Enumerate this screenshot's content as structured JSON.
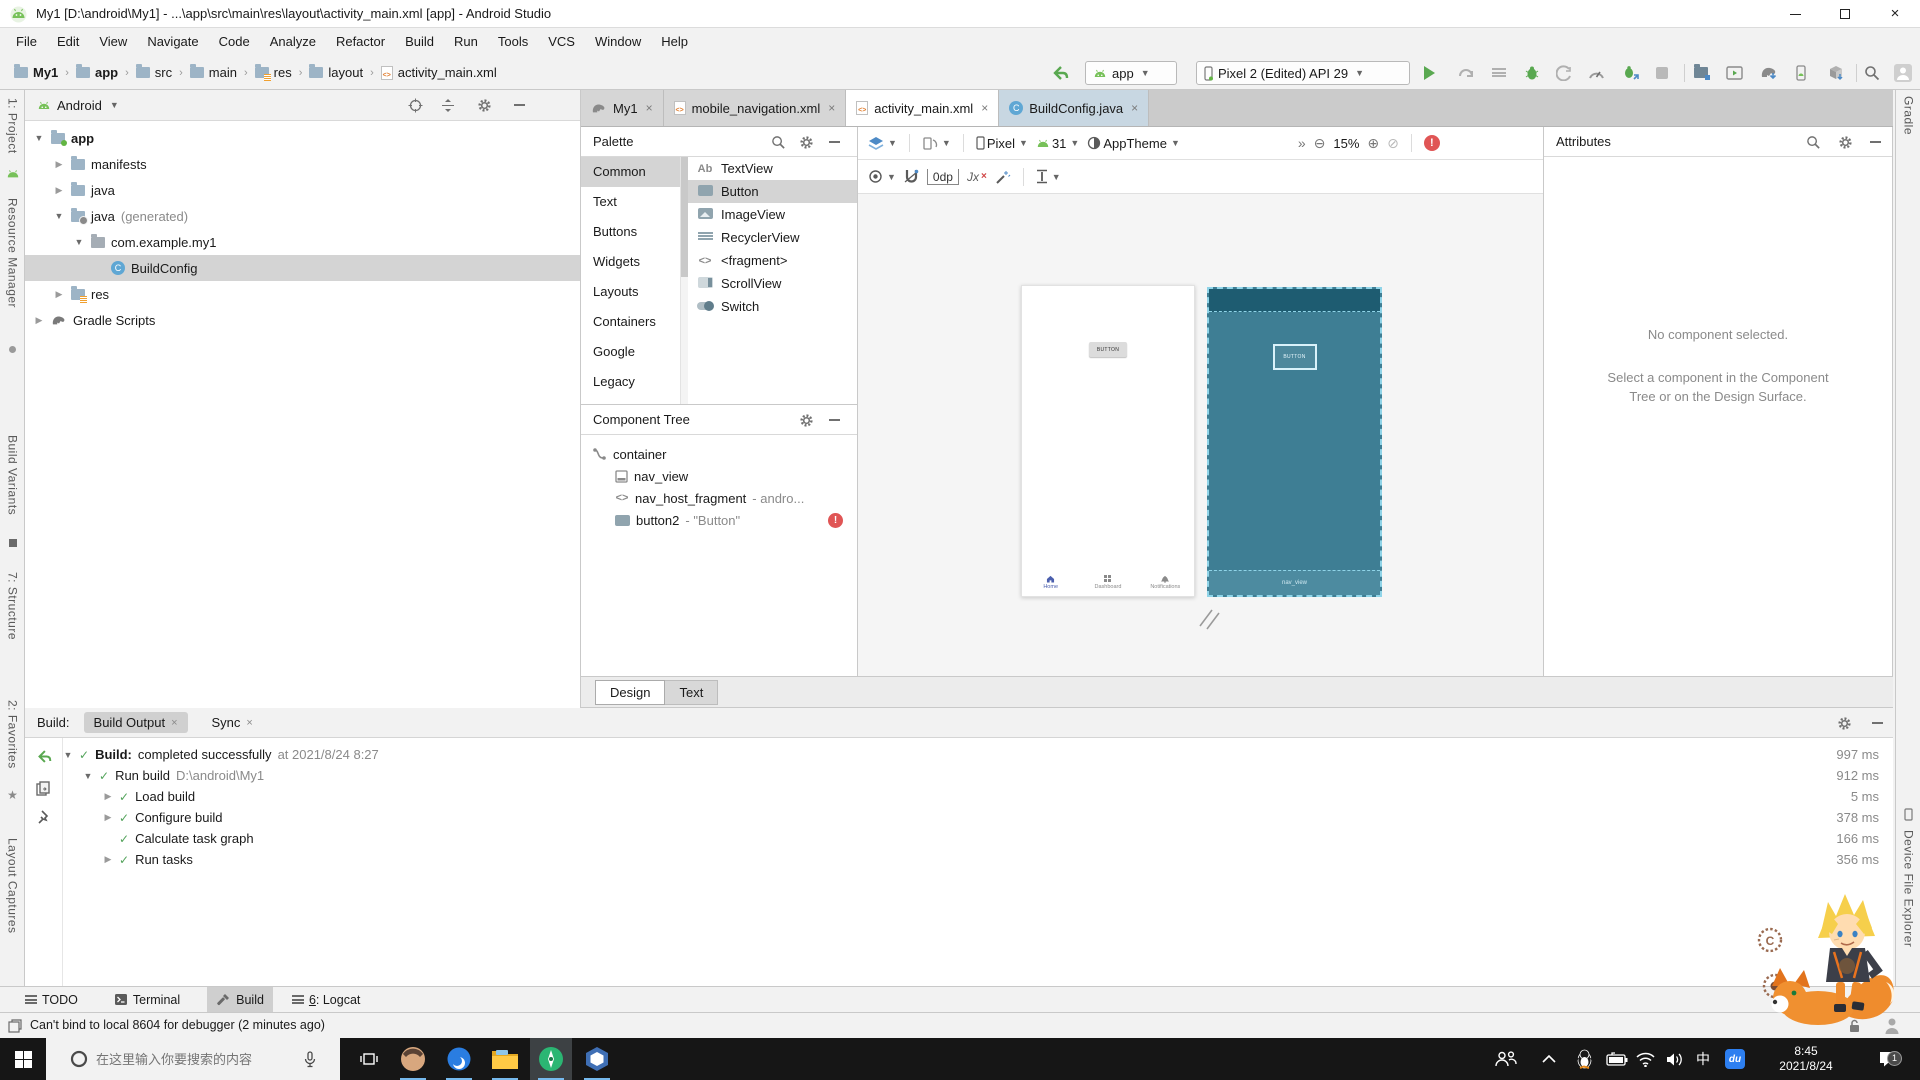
{
  "title_bar": {
    "title": "My1 [D:\\android\\My1] - ...\\app\\src\\main\\res\\layout\\activity_main.xml [app] - Android Studio"
  },
  "menu_bar": {
    "items": [
      "File",
      "Edit",
      "View",
      "Navigate",
      "Code",
      "Analyze",
      "Refactor",
      "Build",
      "Run",
      "Tools",
      "VCS",
      "Window",
      "Help"
    ]
  },
  "toolbar": {
    "breadcrumbs": [
      "My1",
      "app",
      "src",
      "main",
      "res",
      "layout",
      "activity_main.xml"
    ],
    "run_config": "app",
    "device": "Pixel 2 (Edited) API 29"
  },
  "left_strip": {
    "project": "1: Project",
    "resource_manager": "Resource Manager",
    "build_variants": "Build Variants",
    "structure": "7: Structure",
    "favorites": "2: Favorites",
    "layout_captures": "Layout Captures"
  },
  "right_strip": {
    "gradle": "Gradle",
    "device_file_explorer": "Device File Explorer"
  },
  "project_panel": {
    "mode": "Android",
    "tree": [
      {
        "label": "app"
      },
      {
        "label": "manifests"
      },
      {
        "label": "java"
      },
      {
        "label": "java",
        "suffix": " (generated)"
      },
      {
        "label": "com.example.my1"
      },
      {
        "label": "BuildConfig"
      },
      {
        "label": "res"
      },
      {
        "label": "Gradle Scripts"
      }
    ]
  },
  "editor_tabs": [
    {
      "label": "My1"
    },
    {
      "label": "mobile_navigation.xml"
    },
    {
      "label": "activity_main.xml"
    },
    {
      "label": "BuildConfig.java"
    }
  ],
  "palette": {
    "title": "Palette",
    "categories": [
      "Common",
      "Text",
      "Buttons",
      "Widgets",
      "Layouts",
      "Containers",
      "Google",
      "Legacy"
    ],
    "items": [
      {
        "glyph": "Ab",
        "label": "TextView"
      },
      {
        "label": "Button"
      },
      {
        "label": "ImageView"
      },
      {
        "label": "RecyclerView"
      },
      {
        "glyph": "<>",
        "label": "<fragment>"
      },
      {
        "label": "ScrollView"
      },
      {
        "label": "Switch"
      }
    ]
  },
  "component_tree": {
    "title": "Component Tree",
    "items": [
      {
        "label": "container"
      },
      {
        "label": "nav_view"
      },
      {
        "label": "nav_host_fragment",
        "suffix": "- andro..."
      },
      {
        "label": "button2",
        "suffix": "- \"Button\""
      }
    ],
    "fragment_glyph": "<>"
  },
  "design_toolbar": {
    "device_type": "Pixel",
    "api_level": "31",
    "theme": "AppTheme",
    "overflow": "»",
    "zoom_pct": "15%",
    "margin": "0dp",
    "constraints_glyph": "Jx"
  },
  "design_surface": {
    "button_label": "BUTTON",
    "nav_view_label": "nav_view",
    "bottom_nav": [
      "Home",
      "Dashboard",
      "Notifications"
    ]
  },
  "attributes_panel": {
    "title": "Attributes",
    "empty_title": "No component selected.",
    "empty_hint": "Select a component in the Component Tree or on the Design Surface."
  },
  "editor_mode_tabs": {
    "design": "Design",
    "text": "Text"
  },
  "build_panel": {
    "label": "Build:",
    "tabs": [
      {
        "label": "Build Output"
      },
      {
        "label": "Sync"
      }
    ],
    "rows": [
      {
        "bold": "Build:",
        "text": "completed successfully",
        "gray": "at 2021/8/24 8:27",
        "time": "997 ms"
      },
      {
        "text": "Run build",
        "gray": "D:\\android\\My1",
        "time": "912 ms"
      },
      {
        "text": "Load build",
        "time": "5 ms"
      },
      {
        "text": "Configure build",
        "time": "378 ms"
      },
      {
        "text": "Calculate task graph",
        "time": "166 ms"
      },
      {
        "text": "Run tasks",
        "time": "356 ms"
      }
    ]
  },
  "tool_window_bar": {
    "todo": "TODO",
    "terminal": "Terminal",
    "build": "Build",
    "logcat_num": "6",
    "logcat_rest": ": Logcat"
  },
  "status_bar": {
    "message": "Can't bind to local 8604 for debugger (2 minutes ago)"
  },
  "taskbar": {
    "search_placeholder": "在这里输入你要搜索的内容",
    "ime": "中",
    "ime_brand": "du",
    "time": "8:45",
    "date": "2021/8/24",
    "badge": "1"
  },
  "icons": {
    "class_glyph": "C",
    "stamp_glyph": "C"
  }
}
